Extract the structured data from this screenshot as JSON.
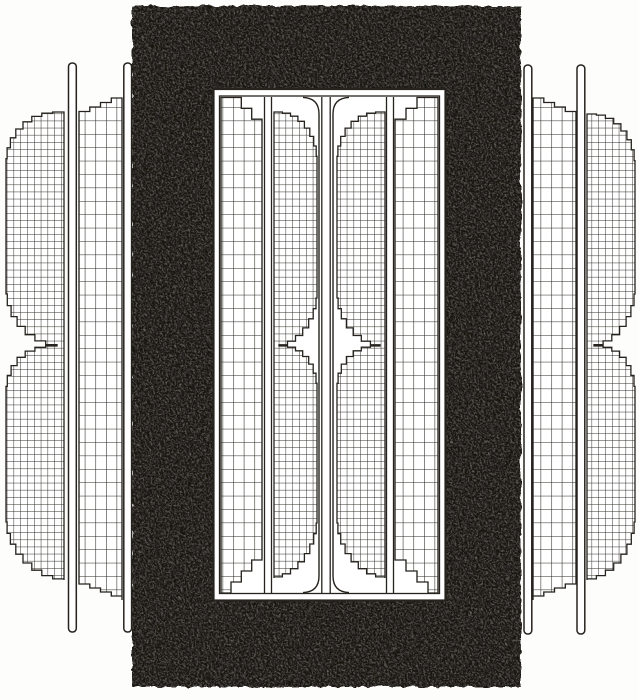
{
  "figure": {
    "kind": "engraved-technical-illustration",
    "subject": "Cross-section of a transformer: black laminated core with window, coil windings shown as cross-hatched sections",
    "visible_text": [],
    "palette": {
      "paper": "#fdfdfb",
      "ink": "#26231e",
      "core_black": "#151210",
      "core_speckle": "#57524b",
      "coil_fill": "#ffffff"
    },
    "parts": [
      {
        "name": "magnetic-core",
        "appearance": "solid black mass with mottled scan texture, rectangular with inner window"
      },
      {
        "name": "core-window",
        "appearance": "white opening outlined by a double-line frame"
      },
      {
        "name": "center-divider",
        "appearance": "four vertical lines down the window center, curving into the frame at top and bottom"
      },
      {
        "name": "winding-group",
        "count": 4,
        "sections": [
          "coarse-grid strip coil with stepped corner chamfers",
          "fine-grid disc coil shaped like an hourglass (two stacked stepped half-discs with a waist notch)"
        ],
        "formers": "thin white rails with rounded caps flanking the outer strip coils"
      }
    ],
    "grid_cells": {
      "fine": [
        6.8,
        7.1
      ],
      "coarse": [
        10.6,
        13.4
      ]
    },
    "waist_y": 346
  }
}
